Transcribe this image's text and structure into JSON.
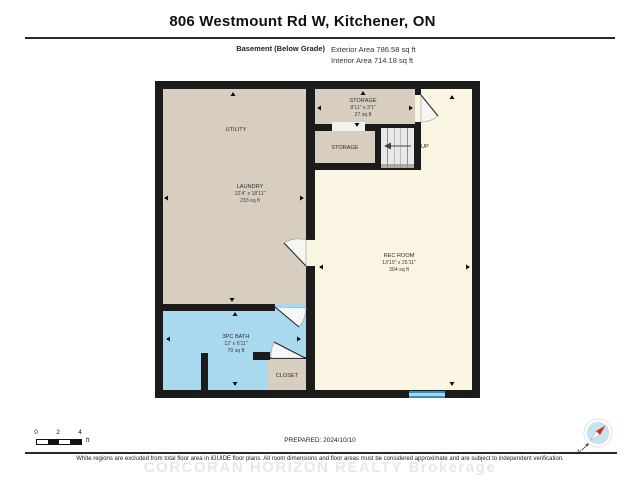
{
  "header": {
    "title": "806 Westmount Rd W, Kitchener, ON",
    "floor_label": "Basement (Below Grade)",
    "exterior_area": "Exterior Area 786.58 sq ft",
    "interior_area": "Interior Area 714.18 sq ft"
  },
  "rooms": {
    "utility": {
      "name": "UTILITY"
    },
    "laundry": {
      "name": "LAUNDRY",
      "dims": "12'4\" x 18'11\"",
      "area": "233 sq ft"
    },
    "storage_upper": {
      "name": "STORAGE",
      "dims": "8'11\" x 3'1\"",
      "area": "27 sq ft"
    },
    "storage_lower": {
      "name": "STORAGE"
    },
    "rec_room": {
      "name": "REC ROOM",
      "dims": "13'10\" x 25'11\"",
      "area": "304 sq ft"
    },
    "bath": {
      "name": "3PC BATH",
      "dims": "12' x 6'11\"",
      "area": "70 sq ft"
    },
    "closet": {
      "name": "CLOSET"
    },
    "stairs": {
      "up_label": "UP"
    }
  },
  "scale_bar": {
    "ticks": [
      "0",
      "2",
      "4"
    ],
    "unit": "ft"
  },
  "compass": {
    "north_label": "N"
  },
  "footer": {
    "prepared": "PREPARED: 2024/10/10",
    "disclaimer": "White regions are excluded from total floor area in iGUIDE floor plans. All room dimensions and floor areas must be considered approximate and are subject to independent verification.",
    "watermark": "CORCORAN HORIZON REALTY Brokerage"
  },
  "colors": {
    "walls": "#1b1b1b",
    "room_tan": "#d8cec0",
    "room_cream": "#faf5e2",
    "room_bath_blue": "#a9d9ee",
    "window_blue": "#2e8fc0",
    "window_light": "#a6d7ef",
    "stairs_gray": "#e9e9e9"
  }
}
